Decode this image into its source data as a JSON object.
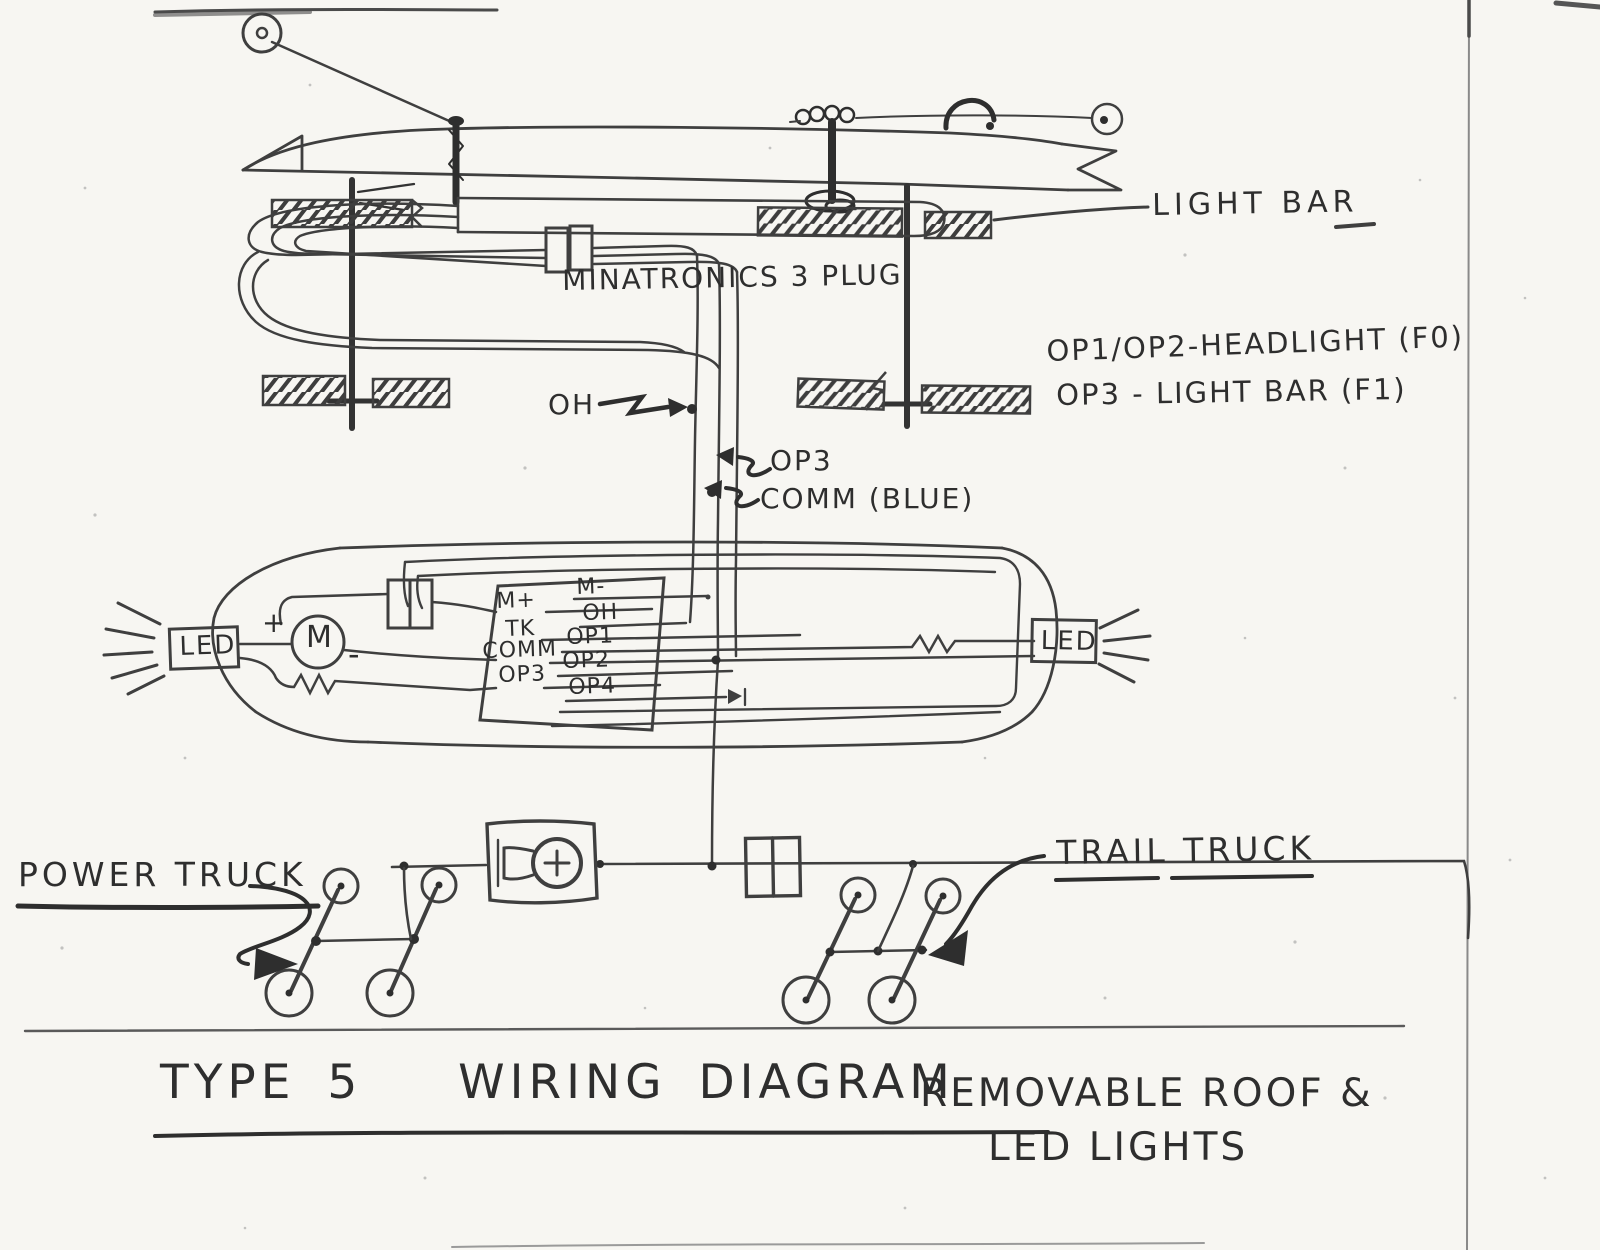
{
  "colors": {
    "paper": "#f7f6f2",
    "pencil": "#3f3f3f",
    "dark_pencil": "#2e2e2e"
  },
  "drawing": {
    "roof": {
      "light_bar_label": "LIGHT BAR",
      "plug_label": "MINATRONICS 3 PLUG"
    },
    "functions": {
      "line1": "OP1/OP2-HEADLIGHT (F0)",
      "line2": "OP3 - LIGHT BAR (F1)"
    },
    "wire_tags": {
      "oh": "OH",
      "op3": "OP3",
      "comm": "COMM (BLUE)"
    },
    "body": {
      "led_left": "LED",
      "led_right": "LED",
      "motor": "M",
      "motor_plus": "+",
      "motor_minus": "-",
      "decoder": {
        "left_pins": [
          "M+",
          "TK",
          "COMM",
          "OP3"
        ],
        "right_pins": [
          "M-",
          "OH",
          "OP1",
          "OP2",
          "OP4"
        ]
      }
    },
    "chassis": {
      "power_truck": "POWER TRUCK",
      "trail_truck": "TRAIL TRUCK"
    },
    "titles": {
      "main": "TYPE 5   WIRING DIAGRAM",
      "sub1": "REMOVABLE ROOF &",
      "sub2": "LED LIGHTS"
    }
  }
}
